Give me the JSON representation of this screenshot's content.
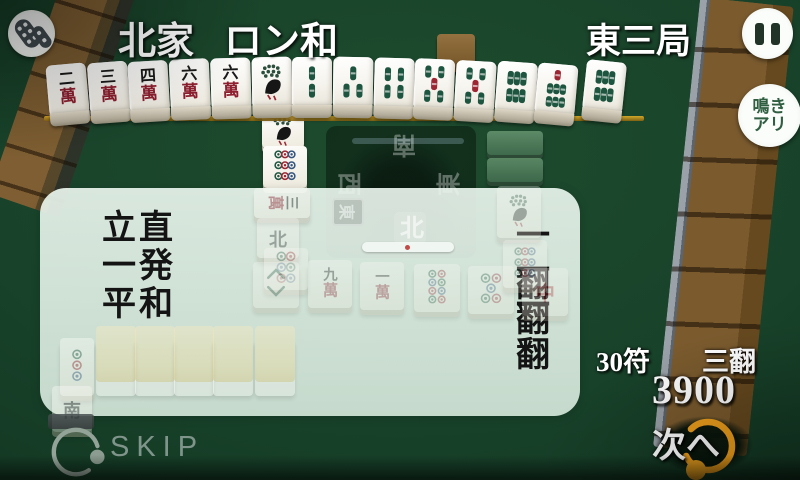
{
  "header": {
    "seat": "北家",
    "event": "ロン和",
    "round": "東三局"
  },
  "center": {
    "top": "南",
    "left": "西",
    "right": "東",
    "bottom": "北",
    "round_marker": "東"
  },
  "yaku_panel": {
    "rows": [
      {
        "name": "立直",
        "han": "一翻"
      },
      {
        "name": "一発",
        "han": "一翻"
      },
      {
        "name": "平和",
        "han": "一翻"
      }
    ]
  },
  "score": {
    "fu": "30符",
    "han": "三翻",
    "points": "3900"
  },
  "buttons": {
    "skip": "SKIP",
    "next": "次へ",
    "naki_line1": "鳴き",
    "naki_line2": "アリ"
  },
  "hand": {
    "tiles": [
      "2m",
      "3m",
      "4m",
      "6m",
      "6m",
      "1s",
      "2s",
      "3s",
      "4s",
      "5s",
      "5s",
      "6s",
      "7s"
    ],
    "winning_tile": "6s"
  },
  "tile_text": {
    "man_numbers": {
      "1": "一",
      "2": "二",
      "3": "三",
      "4": "四",
      "5": "五",
      "6": "六",
      "9": "九"
    },
    "man_suffix": "萬",
    "chun": "中",
    "north": "北",
    "south": "南"
  },
  "colors": {
    "felt": "#18422a",
    "panel": "#e8f5ec",
    "accent_orange": "#f2a11c",
    "wall_brown": "#7b5b2e",
    "bamboo_green": "#1e5540",
    "tile_red": "#9c2733",
    "skip_gray": "#7f948a",
    "naki_green": "#2f5e40"
  },
  "ghosts": {
    "board": [
      {
        "x": 262,
        "y": 114,
        "w": 42,
        "h": 34,
        "kind": "bird",
        "op": 1
      },
      {
        "x": 263,
        "y": 146,
        "w": 44,
        "h": 42,
        "kind": "9p",
        "op": 1
      },
      {
        "x": 487,
        "y": 131,
        "w": 56,
        "h": 24,
        "kind": "back-green",
        "op": 1
      },
      {
        "x": 487,
        "y": 158,
        "w": 56,
        "h": 24,
        "kind": "back-green",
        "op": 0.95
      }
    ],
    "washed": [
      {
        "x": 254,
        "y": 188,
        "w": 56,
        "h": 30,
        "kind": "3m",
        "rot": 90,
        "op": 0.42
      },
      {
        "x": 257,
        "y": 218,
        "w": 42,
        "h": 40,
        "kind": "north",
        "op": 0.34
      },
      {
        "x": 264,
        "y": 248,
        "w": 44,
        "h": 42,
        "kind": "6p",
        "op": 0.3
      },
      {
        "x": 253,
        "y": 262,
        "w": 46,
        "h": 46,
        "kind": "8s",
        "op": 0.3
      },
      {
        "x": 308,
        "y": 260,
        "w": 44,
        "h": 48,
        "kind": "9m",
        "op": 0.32
      },
      {
        "x": 360,
        "y": 262,
        "w": 44,
        "h": 48,
        "kind": "1m",
        "op": 0.32
      },
      {
        "x": 414,
        "y": 264,
        "w": 46,
        "h": 48,
        "kind": "8p",
        "op": 0.3
      },
      {
        "x": 468,
        "y": 266,
        "w": 46,
        "h": 48,
        "kind": "5p",
        "op": 0.3
      },
      {
        "x": 522,
        "y": 268,
        "w": 46,
        "h": 48,
        "kind": "chun",
        "op": 0.3
      },
      {
        "x": 497,
        "y": 186,
        "w": 44,
        "h": 52,
        "kind": "bird",
        "op": 0.3
      },
      {
        "x": 503,
        "y": 240,
        "w": 44,
        "h": 48,
        "kind": "9p",
        "op": 0.28
      },
      {
        "x": 96,
        "y": 326,
        "w": 40,
        "h": 56,
        "kind": "back-yellow",
        "op": 0.42
      },
      {
        "x": 135,
        "y": 326,
        "w": 40,
        "h": 56,
        "kind": "back-yellow",
        "op": 0.42
      },
      {
        "x": 174,
        "y": 326,
        "w": 40,
        "h": 56,
        "kind": "back-yellow",
        "op": 0.42
      },
      {
        "x": 213,
        "y": 326,
        "w": 40,
        "h": 56,
        "kind": "back-yellow",
        "op": 0.42
      },
      {
        "x": 255,
        "y": 326,
        "w": 40,
        "h": 56,
        "kind": "back-yellow",
        "op": 0.42
      },
      {
        "x": 60,
        "y": 338,
        "w": 34,
        "h": 58,
        "kind": "3p",
        "op": 0.4
      },
      {
        "x": 52,
        "y": 386,
        "w": 40,
        "h": 46,
        "kind": "nan",
        "op": 0.4
      },
      {
        "x": 48,
        "y": 414,
        "w": 46,
        "h": 15,
        "kind": "shadow",
        "op": 0.85
      }
    ]
  }
}
